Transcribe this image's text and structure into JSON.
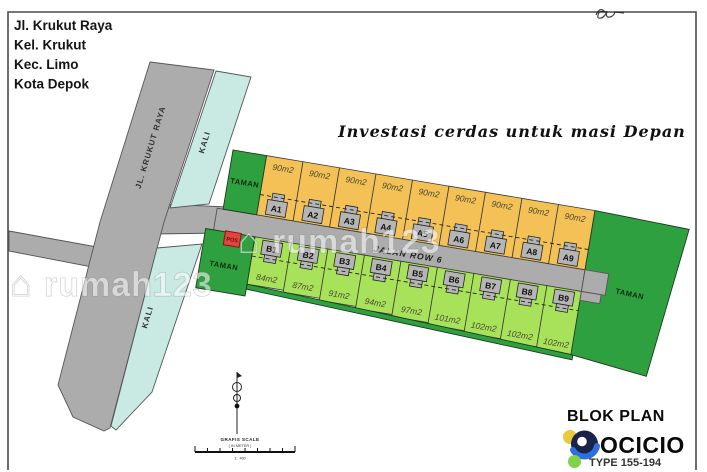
{
  "address": {
    "line1": "Jl. Krukut Raya",
    "line2": "Kel.  Krukut",
    "line3": "Kec.  Limo",
    "line4": "Kota Depok"
  },
  "tagline": "Investasi cerdas untuk masi Depan",
  "watermark": {
    "icon_glyph": "⌂",
    "text": "rumah123"
  },
  "roads": {
    "main": "JL. KRUKUT RAYA",
    "river": "KALI",
    "site_road": "JALAN ROW 6"
  },
  "site": {
    "park": "TAMAN",
    "pos": "POS",
    "plots_a": [
      {
        "id": "A1",
        "area": "90m2"
      },
      {
        "id": "A2",
        "area": "90m2"
      },
      {
        "id": "A3",
        "area": "90m2"
      },
      {
        "id": "A4",
        "area": "90m2"
      },
      {
        "id": "A5",
        "area": "90m2"
      },
      {
        "id": "A6",
        "area": "90m2"
      },
      {
        "id": "A7",
        "area": "90m2"
      },
      {
        "id": "A8",
        "area": "90m2"
      },
      {
        "id": "A9",
        "area": "90m2"
      }
    ],
    "plots_b": [
      {
        "id": "B1",
        "area": "84m2"
      },
      {
        "id": "B2",
        "area": "87m2"
      },
      {
        "id": "B3",
        "area": "91m2"
      },
      {
        "id": "B4",
        "area": "94m2"
      },
      {
        "id": "B5",
        "area": "97m2"
      },
      {
        "id": "B6",
        "area": "101m2"
      },
      {
        "id": "B7",
        "area": "102m2"
      },
      {
        "id": "B8",
        "area": "102m2"
      },
      {
        "id": "B9",
        "area": "102m2"
      }
    ]
  },
  "legend": {
    "title": "BLOK PLAN",
    "brand": "OCICIO",
    "type_range": "TYPE 155-194"
  },
  "scale_bar": {
    "title": "GRAFIS SCALE",
    "unit": "( IN METER )",
    "ratio": "1 : 400"
  },
  "colors": {
    "plot_a": "#F3C155",
    "plot_b": "#A8E25A",
    "park_green": "#2FA040",
    "river_cyan": "#C9E9E3",
    "road_gray": "#ACACAC",
    "pos_red": "#E2453E",
    "legend_dot_yellow": "#E9C93F",
    "legend_dot_green": "#7ED348",
    "logo_navy": "#19244A",
    "logo_blue": "#2E6FE0"
  }
}
